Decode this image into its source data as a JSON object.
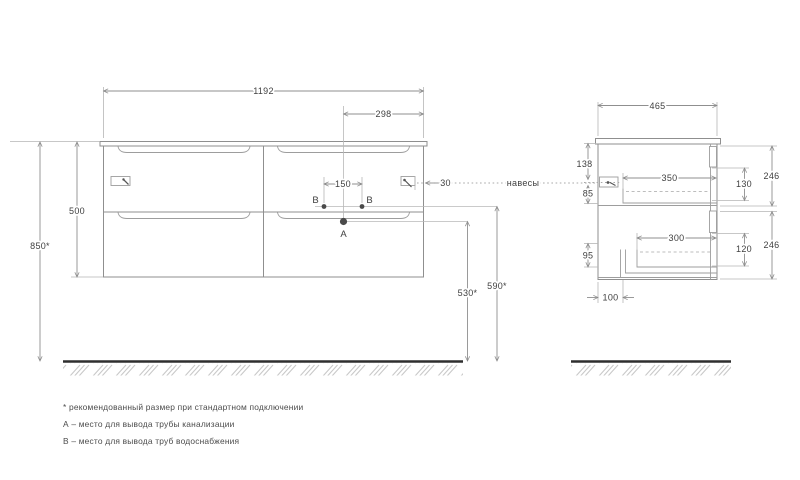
{
  "front_view": {
    "width": "1192",
    "right_section_width": "298",
    "cabinet_height": "500",
    "total_height": "850*",
    "outlet_b_spacing": "150",
    "hanger_edge_offset": "30",
    "outlet_a_height": "530*",
    "outlet_b_height": "590*",
    "point_a": "A",
    "point_b_left": "B",
    "point_b_right": "B"
  },
  "side_view": {
    "depth": "465",
    "top_to_hanger": "138",
    "hanger_to_drawer_bottom": "85",
    "top_drawer_depth": "350",
    "top_drawer_inner_height": "130",
    "top_drawer_front_height": "246",
    "bottom_drawer_depth": "300",
    "bottom_drawer_inner_height": "120",
    "bottom_drawer_front_height": "246",
    "bottom_clearance": "95",
    "pipe_offset": "100"
  },
  "annotations": {
    "hangers": "навесы"
  },
  "notes": {
    "recommended": "* рекомендованный размер при стандартном подключении",
    "point_a": "А – место для вывода трубы канализации",
    "point_b": "В – место для вывода труб водоснабжения"
  },
  "colors": {
    "drawing_line": "#8f8f8f",
    "floor_line": "#2e2e2e",
    "text": "#3f3f3f",
    "hatch": "#c9c9c9"
  }
}
